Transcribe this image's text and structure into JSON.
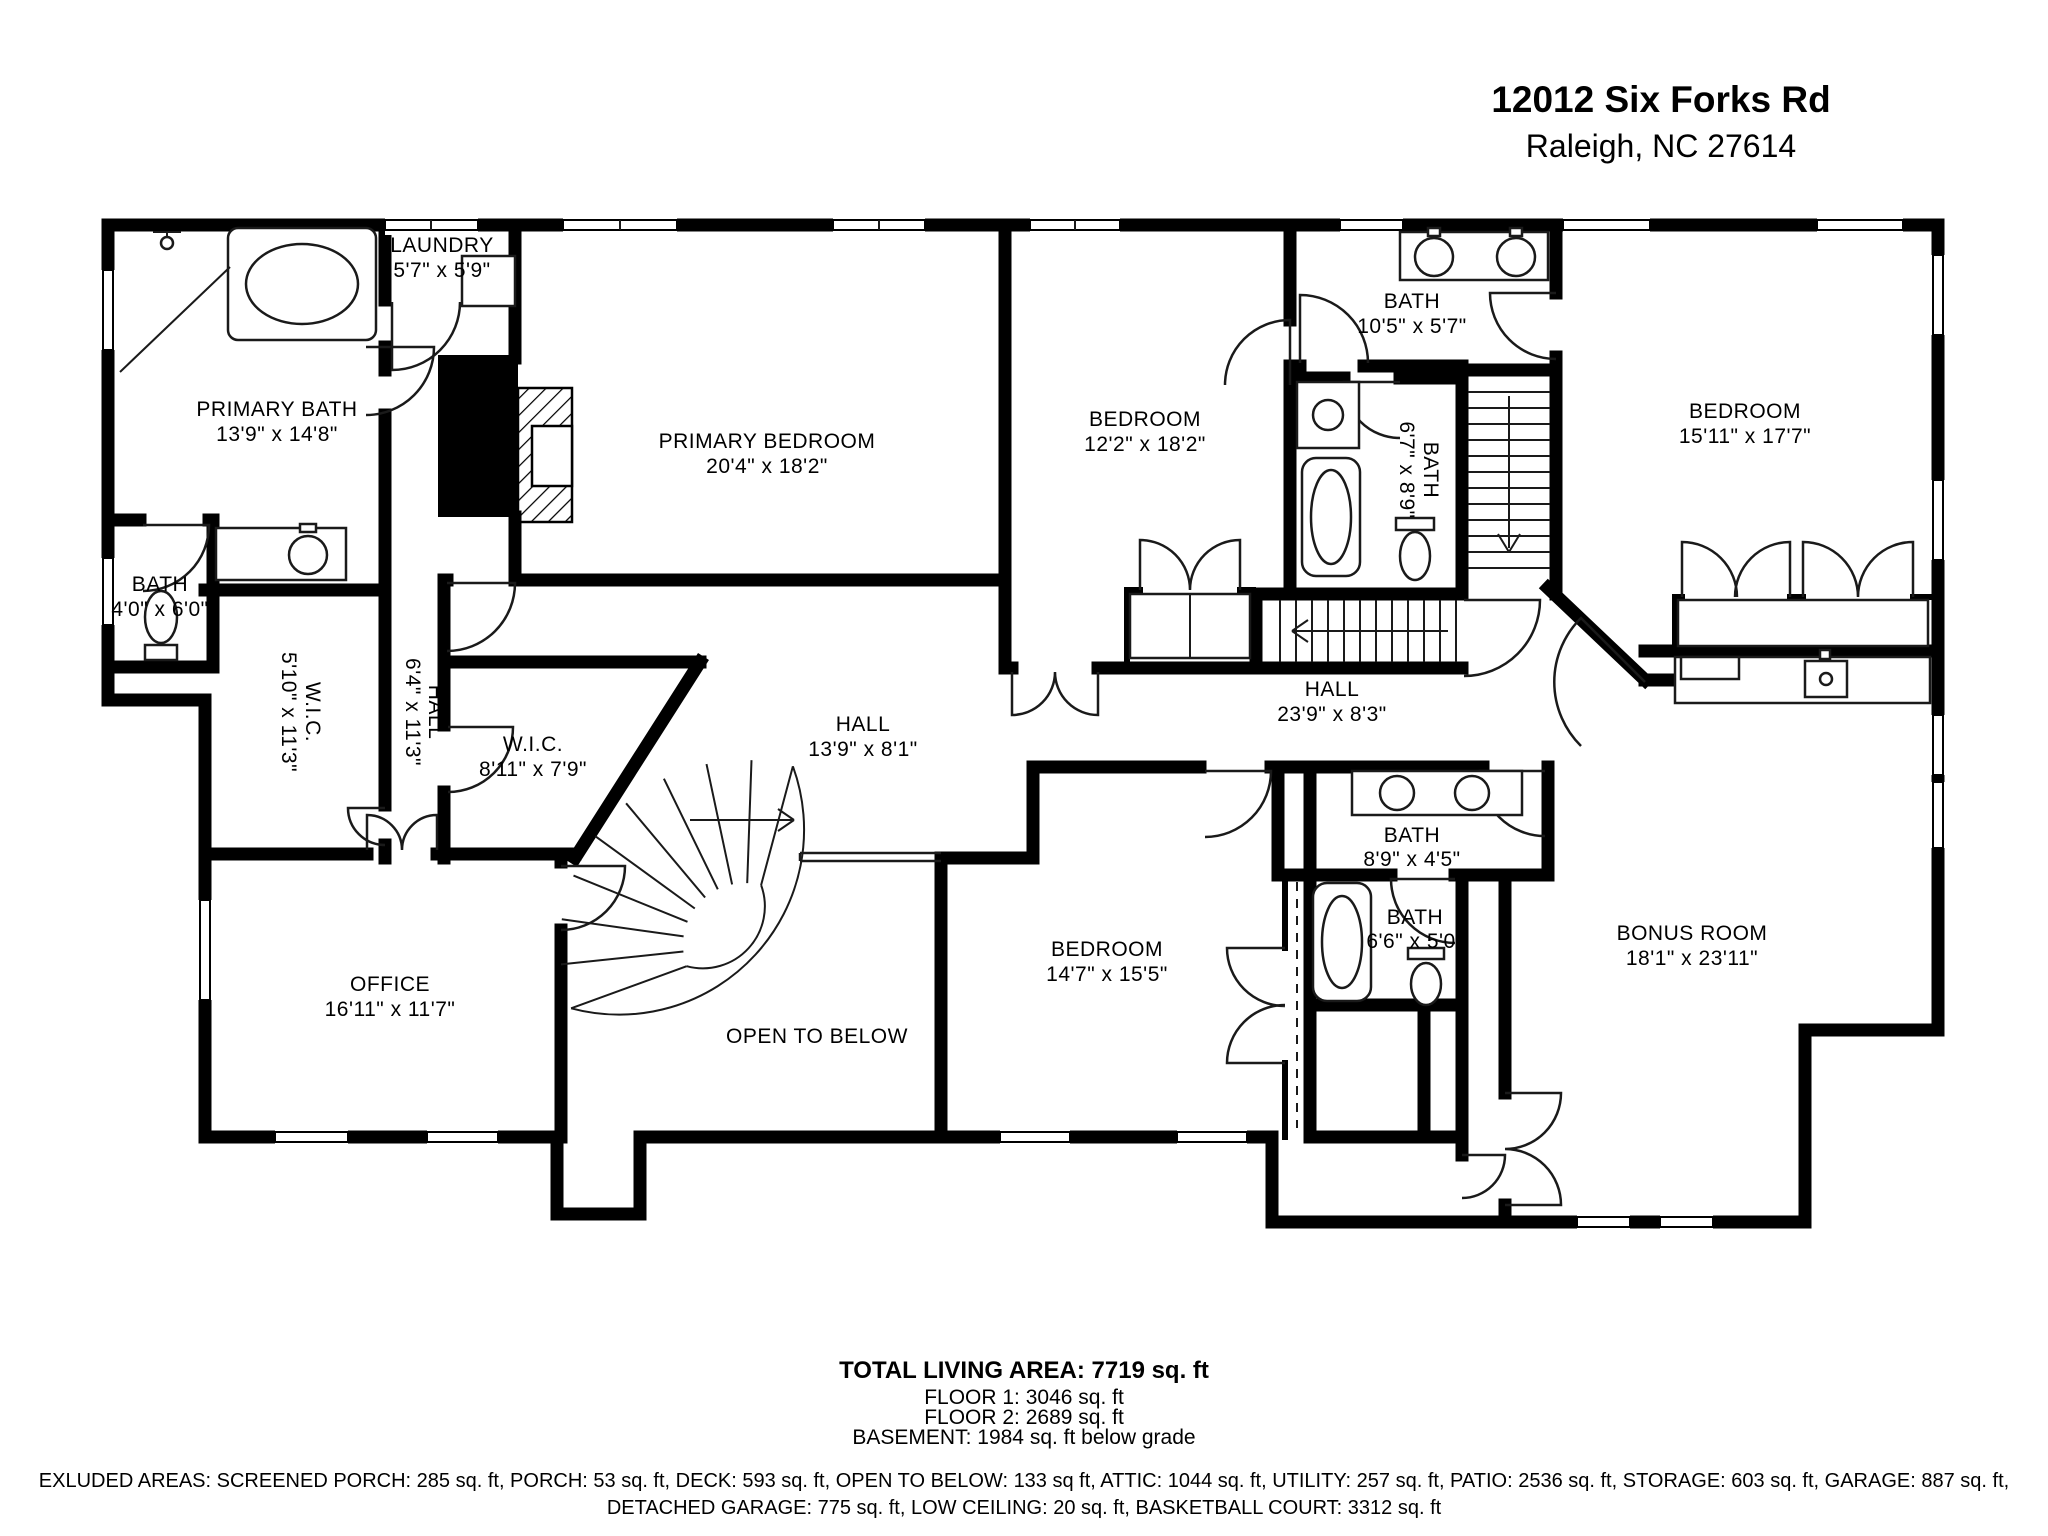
{
  "header": {
    "address_line1": "12012 Six Forks Rd",
    "address_line2": "Raleigh, NC 27614"
  },
  "rooms": [
    {
      "id": "laundry",
      "name": "LAUNDRY",
      "dims": "5'7\" x 5'9\""
    },
    {
      "id": "primary-bath",
      "name": "PRIMARY BATH",
      "dims": "13'9\" x 14'8\""
    },
    {
      "id": "primary-bedroom",
      "name": "PRIMARY BEDROOM",
      "dims": "20'4\" x 18'2\""
    },
    {
      "id": "bedroom-12",
      "name": "BEDROOM",
      "dims": "12'2\" x 18'2\""
    },
    {
      "id": "bath-105",
      "name": "BATH",
      "dims": "10'5\" x 5'7\""
    },
    {
      "id": "bath-67",
      "name": "BATH",
      "dims": "6'7\" x 8'9\""
    },
    {
      "id": "bedroom-15",
      "name": "BEDROOM",
      "dims": "15'11\" x 17'7\""
    },
    {
      "id": "bath-40",
      "name": "BATH",
      "dims": "4'0\" x 6'0\""
    },
    {
      "id": "wic-510",
      "name": "W.I.C.",
      "dims": "5'10\" x 11'3\""
    },
    {
      "id": "hall-64",
      "name": "HALL",
      "dims": "6'4\" x 11'3\""
    },
    {
      "id": "wic-811",
      "name": "W.I.C.",
      "dims": "8'11\" x 7'9\""
    },
    {
      "id": "hall-139",
      "name": "HALL",
      "dims": "13'9\" x 8'1\""
    },
    {
      "id": "hall-239",
      "name": "HALL",
      "dims": "23'9\" x 8'3\""
    },
    {
      "id": "office",
      "name": "OFFICE",
      "dims": "16'11\" x 11'7\""
    },
    {
      "id": "open-to-below",
      "name": "OPEN TO BELOW",
      "dims": ""
    },
    {
      "id": "bedroom-14",
      "name": "BEDROOM",
      "dims": "14'7\" x 15'5\""
    },
    {
      "id": "bath-89",
      "name": "BATH",
      "dims": "8'9\" x 4'5\""
    },
    {
      "id": "bath-66",
      "name": "BATH",
      "dims": "6'6\" x 5'0\""
    },
    {
      "id": "bonus-room",
      "name": "BONUS ROOM",
      "dims": "18'1\" x 23'11\""
    }
  ],
  "summary": {
    "total": "TOTAL LIVING AREA: 7719 sq. ft",
    "floor1": "FLOOR 1: 3046 sq. ft",
    "floor2": "FLOOR 2: 2689 sq. ft",
    "basement": "BASEMENT: 1984 sq. ft below grade"
  },
  "excluded": {
    "line1": "EXLUDED AREAS: SCREENED PORCH: 285 sq. ft, PORCH: 53 sq. ft, DECK: 593 sq. ft, OPEN TO BELOW: 133 sq ft, ATTIC: 1044 sq. ft, UTILITY: 257 sq. ft, PATIO: 2536 sq. ft, STORAGE: 603 sq. ft, GARAGE: 887 sq. ft,",
    "line2": "DETACHED GARAGE: 775 sq. ft, LOW CEILING: 20 sq. ft, BASKETBALL COURT: 3312 sq. ft"
  }
}
